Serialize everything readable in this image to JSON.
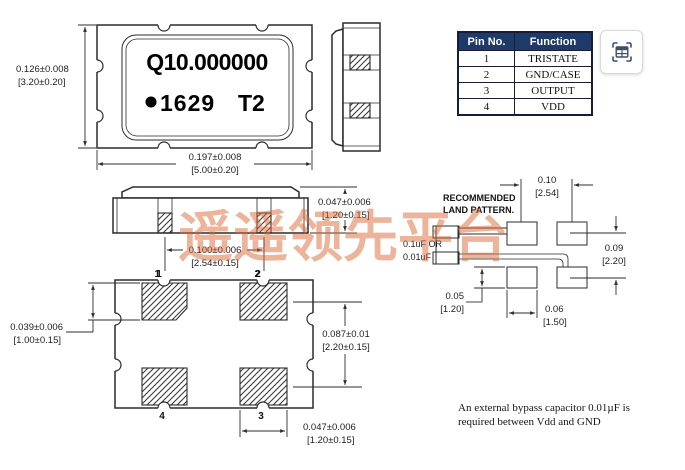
{
  "top_view": {
    "marking_line1": "Q10.000000",
    "marking_line2a": "1629",
    "marking_line2b": "T2",
    "dim_height_in": "0.126±0.008",
    "dim_height_mm": "[3.20±0.20]",
    "dim_width_in": "0.197±0.008",
    "dim_width_mm": "[5.00±0.20]"
  },
  "front_view": {
    "dim_thickness_in": "0.047±0.006",
    "dim_thickness_mm": "[1.20±0.15]",
    "dim_pitch_in": "0.100±0.006",
    "dim_pitch_mm": "[2.54±0.15]",
    "pin1": "1",
    "pin2": "2"
  },
  "bottom_view": {
    "pin1": "1",
    "pin2": "2",
    "pin3": "3",
    "pin4": "4",
    "dim_pad_height_in": "0.039±0.006",
    "dim_pad_height_mm": "[1.00±0.15]",
    "dim_row_pitch_in": "0.087±0.01",
    "dim_row_pitch_mm": "[2.20±0.15]",
    "dim_pad_width_in": "0.047±0.006",
    "dim_pad_width_mm": "[1.20±0.15]"
  },
  "land_pattern": {
    "title_line1": "RECOMMENDED",
    "title_line2": "LAND PATTERN.",
    "cap_line1": "0.1uF OR",
    "cap_line2": "0.01uF",
    "dim_pitch_x_in": "0.10",
    "dim_pitch_x_mm": "[2.54]",
    "dim_pitch_y_in": "0.09",
    "dim_pitch_y_mm": "[2.20]",
    "dim_pad_h_in": "0.05",
    "dim_pad_h_mm": "[1.20]",
    "dim_pad_w_in": "0.06",
    "dim_pad_w_mm": "[1.50]"
  },
  "pin_table": {
    "col1": "Pin No.",
    "col2": "Function",
    "header_bg": "#1e3a68",
    "rows": [
      {
        "pin": "1",
        "fn": "TRISTATE"
      },
      {
        "pin": "2",
        "fn": "GND/CASE"
      },
      {
        "pin": "3",
        "fn": "OUTPUT"
      },
      {
        "pin": "4",
        "fn": "VDD"
      }
    ]
  },
  "note": {
    "line1": "An external bypass capacitor 0.01µF is",
    "line2": "required between Vdd and GND"
  },
  "watermark": {
    "text": "遥遥领先平台",
    "color": "rgba(219,106,58,0.5)"
  },
  "icon": {
    "name": "table-capture"
  }
}
